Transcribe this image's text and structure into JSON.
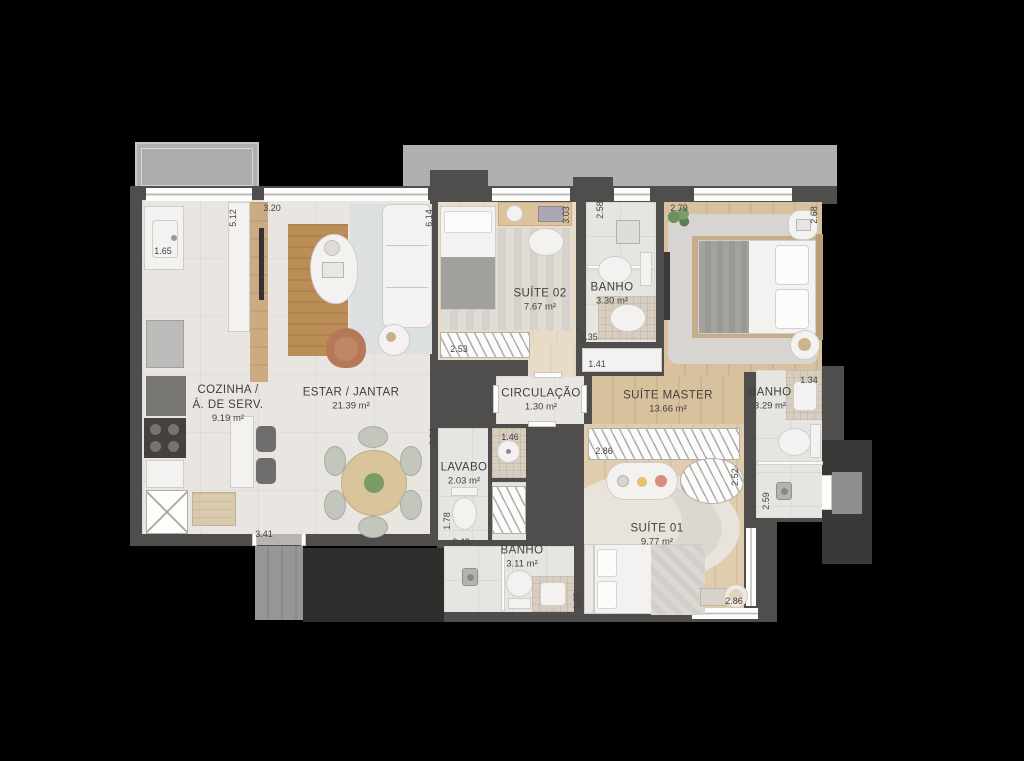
{
  "plan": {
    "rooms": {
      "cozinha": {
        "name": "COZINHA /",
        "name2": "Á. DE SERV.",
        "area": "9.19 m²"
      },
      "estar": {
        "name": "ESTAR / JANTAR",
        "area": "21.39 m²"
      },
      "suite02": {
        "name": "SUÍTE 02",
        "area": "7.67 m²"
      },
      "banho_suite02": {
        "name": "BANHO",
        "area": "3.30 m²"
      },
      "suite_master": {
        "name": "SUÍTE MASTER",
        "area": "13.66 m²"
      },
      "circulacao": {
        "name": "CIRCULAÇÃO",
        "area": "1.30 m²"
      },
      "banho_master": {
        "name": "BANHO",
        "area": "3.29 m²"
      },
      "lavabo": {
        "name": "LAVABO",
        "area": "2.03 m²"
      },
      "banho_suite01": {
        "name": "BANHO",
        "area": "3.11 m²"
      },
      "suite01": {
        "name": "SUÍTE 01",
        "area": "9.77 m²"
      }
    },
    "dimensions": {
      "kitchen_depth": "5.12",
      "living_top_width": "3.20",
      "kitchen_width": "1.65",
      "living_depth": "6.14",
      "suite02_depth": "3.03",
      "banho_suite02_depth": "2.58",
      "master_width": "2.79",
      "master_depth": "2.68",
      "suite02_wardrobe_width": "2.53",
      "banho_suite02_entry": "1.35",
      "hall_niche_width": "1.41",
      "master_wardrobe_width": "2.86",
      "dining_wall": "2.04",
      "lavabo_niche_width": "1.46",
      "banho_master_vanity": "1.34",
      "lavabo_depth": "1.78",
      "banho_suite01_width": "2.43",
      "banho_suite01_wall": "1.35",
      "banho_master_depth": "2.59",
      "suite01_closet_width": "2.52",
      "suite01_window_width": "2.86",
      "living_bottom_width": "3.41"
    },
    "palette": {
      "background": "#000000",
      "walls": "#504e4d",
      "tile_floor": "#e9e6e2",
      "wood_suites": "#e8dcc8",
      "wood_master": "#d8c19e",
      "rug_gray": "#d7d4d1",
      "rug_cream": "#e8e4dc",
      "rug_tan": "#bc8e57",
      "mosaic": "#d8cec0",
      "balcony_slab": "#b2b0ae",
      "outside_dark": "#2f2e2d"
    }
  }
}
